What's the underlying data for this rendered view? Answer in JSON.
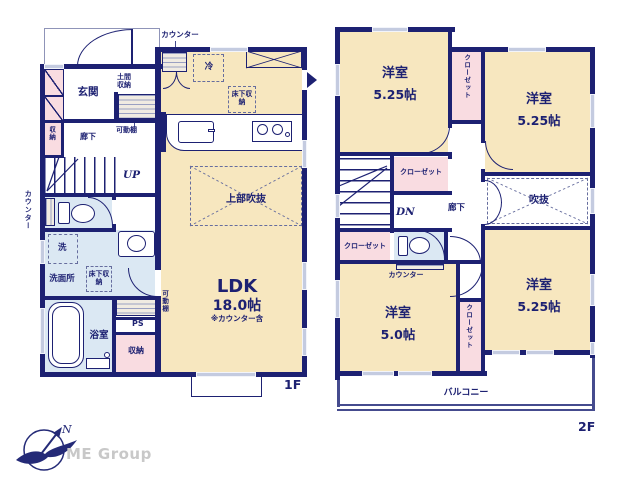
{
  "branding": {
    "logo_text": "ME Group",
    "compass_north": "N"
  },
  "colors": {
    "wall_navy": "#1d2172",
    "room_tan": "#f7e7bf",
    "closet_pink": "#f9dce1",
    "wet_blue": "#dbe8f3",
    "window_blue": "#c4cbe0",
    "logo_gray": "#c8c8c8"
  },
  "floor1": {
    "floor_label": "1F",
    "labels": {
      "counter_top": "カウンター",
      "fridge": "冷",
      "closet_doma": "土間収納",
      "movable_shelf_top": "可動棚",
      "entrance": "玄関",
      "storage_left": "収納",
      "hallway": "廊下",
      "stairs_up": "UP",
      "counter_left": "カウンター",
      "washer": "洗",
      "washroom": "洗面所",
      "underfloor_washroom": "床下収納",
      "bathroom": "浴室",
      "pipe_space": "PS",
      "storage_bottom": "収納",
      "movable_shelf_bottom": "可動棚",
      "underfloor_kitchen": "床下収納",
      "atrium_upper": "上部吹抜",
      "ldk_name": "LDK",
      "ldk_size": "18.0帖",
      "ldk_note": "※カウンター含"
    }
  },
  "floor2": {
    "floor_label": "2F",
    "labels": {
      "room_tl_name": "洋室",
      "room_tl_size": "5.25帖",
      "closet_top": "クローゼット",
      "room_tr_name": "洋室",
      "room_tr_size": "5.25帖",
      "closet_hall": "クローゼット",
      "stairs_down": "DN",
      "hallway": "廊下",
      "closet_left": "クローゼット",
      "counter": "カウンター",
      "atrium": "吹抜",
      "room_bl_name": "洋室",
      "room_bl_size": "5.0帖",
      "closet_bottom": "クローゼット",
      "room_br_name": "洋室",
      "room_br_size": "5.25帖",
      "balcony": "バルコニー"
    }
  }
}
